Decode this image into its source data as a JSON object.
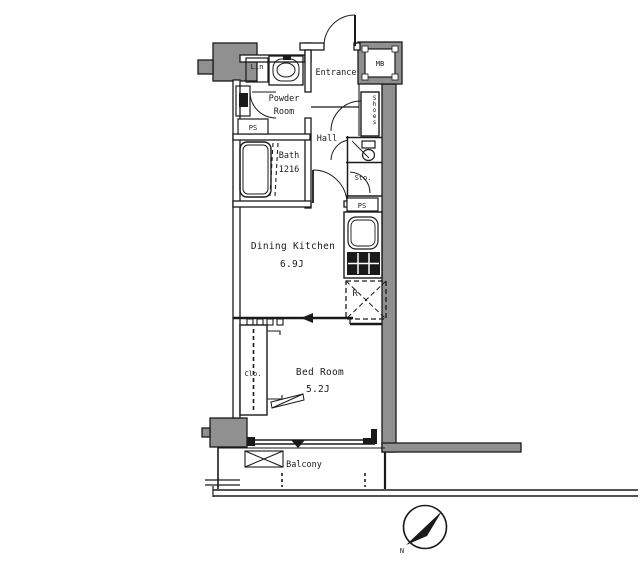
{
  "canvas": {
    "width": 640,
    "height": 569
  },
  "colors": {
    "background": "#ffffff",
    "line": "#1a1a1a",
    "wall_gray": "#909090"
  },
  "rooms": {
    "entrance": "Entrance",
    "hall": "Hall",
    "powder_room_line1": "Powder",
    "powder_room_line2": "Room",
    "bath_label": "Bath",
    "bath_size": "1216",
    "dining_kitchen_label": "Dining Kitchen",
    "dining_kitchen_area": "6.9J",
    "bed_room_label": "Bed Room",
    "bed_room_area": "5.2J",
    "balcony": "Balcony"
  },
  "fixtures": {
    "linen_closet": "Lin",
    "closet": "Clo.",
    "storage": "Sto.",
    "meter_box": "MB",
    "pipe_space_left": "PS",
    "pipe_space_right": "PS",
    "refrigerator": "R",
    "shoe_box": "Shoes"
  },
  "compass": {
    "north": "N"
  }
}
